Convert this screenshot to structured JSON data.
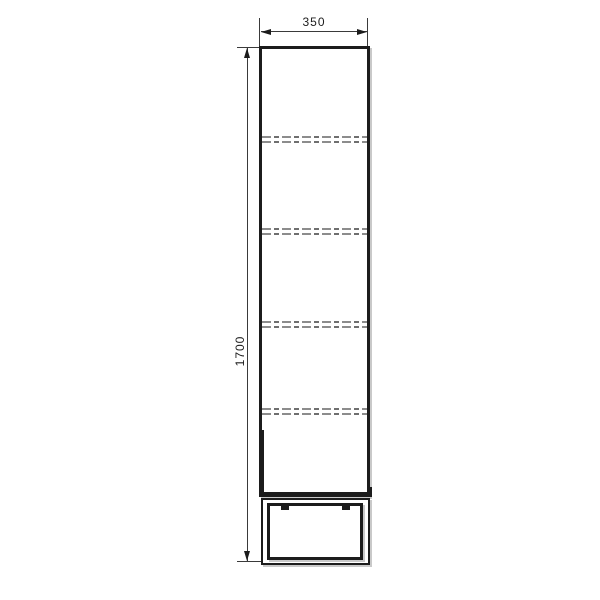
{
  "drawing": {
    "type": "technical-elevation",
    "object": "tall-cabinet-with-plinth",
    "dimensions": {
      "width": {
        "value": "350",
        "orientation": "horizontal",
        "position": "top"
      },
      "height": {
        "value": "1700",
        "orientation": "vertical",
        "position": "left",
        "rotated": true
      }
    },
    "shelves": {
      "style": "hidden-dashed-double-line",
      "count": 4,
      "pairs": [
        {
          "y1": 136,
          "y2": 141
        },
        {
          "y1": 228,
          "y2": 233
        },
        {
          "y1": 321,
          "y2": 326
        },
        {
          "y1": 408,
          "y2": 413
        }
      ]
    },
    "plinth": {
      "hinge_tab_count": 2
    },
    "colors": {
      "line": "#1c1c1c",
      "thin_line": "#3a3a3a",
      "hidden_line_light": "#8c8c8c",
      "hidden_line_dark": "#6f6f6f",
      "shadow": "#c9c9c9",
      "background": "#ffffff"
    }
  }
}
